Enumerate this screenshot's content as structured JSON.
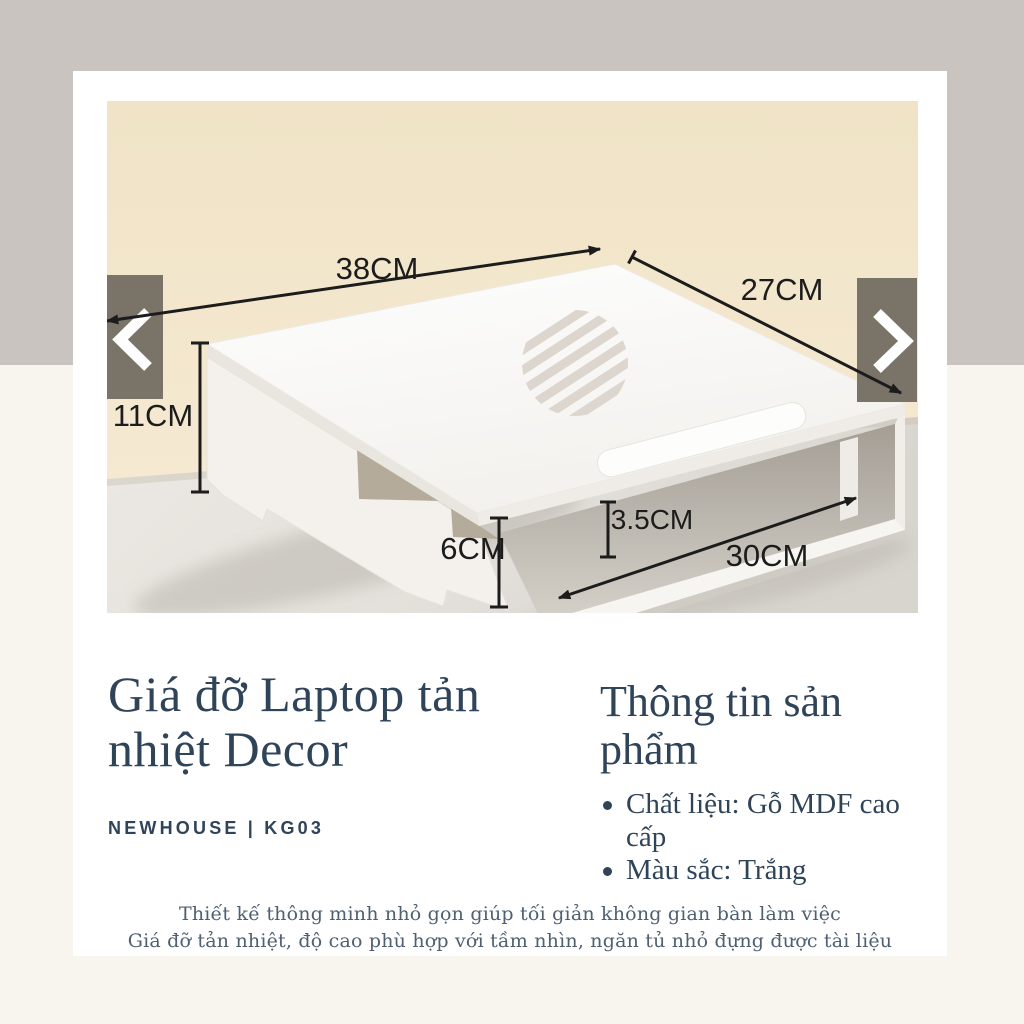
{
  "page": {
    "top_band_color": "#c9c4c0",
    "bottom_band_color": "#f8f5ee",
    "card_color": "#ffffff"
  },
  "carousel": {
    "prev_icon": "chevron-left",
    "next_icon": "chevron-right",
    "button_color": "#7a7368"
  },
  "photo": {
    "wall_color": "#f3e6cc",
    "annotations": {
      "top_width": "38CM",
      "top_depth": "27CM",
      "back_height": "11CM",
      "front_height": "6CM",
      "shelf_opening_height": "3.5CM",
      "shelf_width": "30CM"
    }
  },
  "product": {
    "title": "Giá đỡ Laptop tản nhiệt Decor",
    "brand_line": "NEWHOUSE | KG03",
    "info_heading": "Thông tin sản phẩm",
    "info_bullets": [
      "Chất liệu: Gỗ MDF cao cấp",
      "Màu sắc: Trắng"
    ],
    "description_lines": [
      "Thiết kế thông minh nhỏ gọn giúp tối giản không gian bàn làm việc",
      "Giá đỡ tản nhiệt, độ cao phù hợp với tầm nhìn, ngăn tủ nhỏ đựng được tài liệu"
    ]
  },
  "text_colors": {
    "title": "#304459",
    "annotation": "#1c1c1c",
    "description": "#4e6071"
  }
}
